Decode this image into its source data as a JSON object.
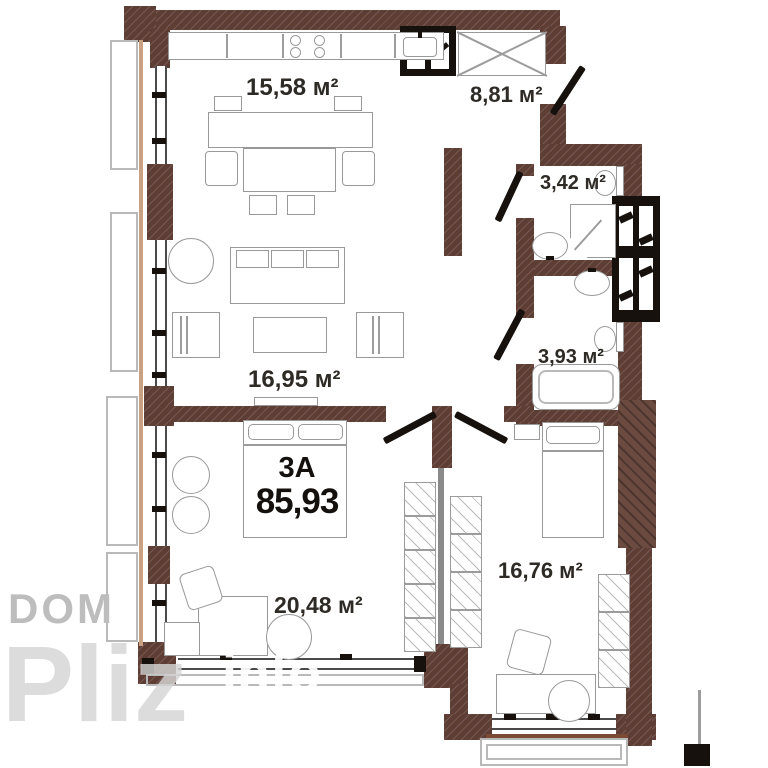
{
  "apartment": {
    "type_label": "3А",
    "total_area": "85,93"
  },
  "rooms": [
    {
      "name": "kitchen-living",
      "area": "15,58 м²"
    },
    {
      "name": "hallway",
      "area": "8,81 м²"
    },
    {
      "name": "bathroom",
      "area": "3,42 м²"
    },
    {
      "name": "wc-bathroom",
      "area": "3,93 м²"
    },
    {
      "name": "living-room",
      "area": "16,95 м²"
    },
    {
      "name": "bedroom-1",
      "area": "20,48 м²"
    },
    {
      "name": "bedroom-2",
      "area": "16,76 м²"
    }
  ],
  "watermark": {
    "brand_top": "DOM",
    "brand_main": "Pliz",
    "brand_suffix": "info"
  },
  "colors": {
    "wall": "#5e3d35",
    "black_elements": "#17110d",
    "furniture_line": "#999999",
    "balcony_line": "#b9b9b9",
    "wood_accent": "#c9a284",
    "label_text": "#2e2a26",
    "watermark_gray": "#bdbdbd",
    "watermark_light": "#d6d6d6",
    "watermark_white": "#ffffff"
  }
}
